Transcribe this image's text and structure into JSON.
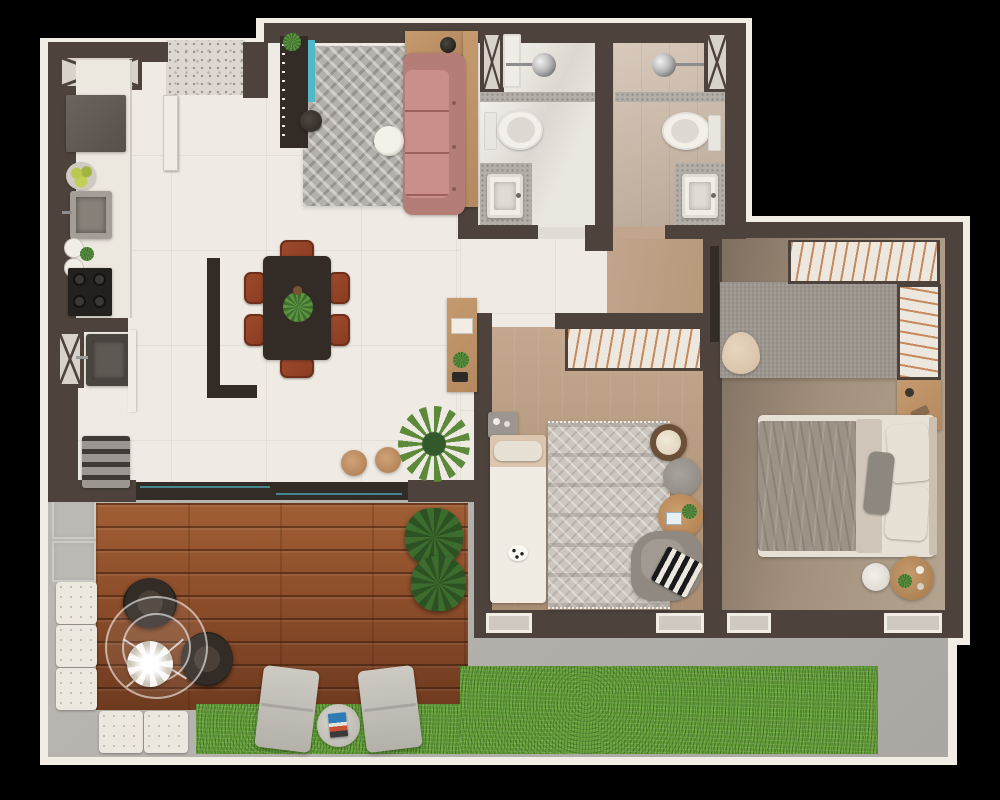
{
  "scene": {
    "kind": "apartment-floor-plan-3d-render",
    "view": "top-down",
    "background": "#000000",
    "visible_text": "none"
  },
  "palette": {
    "background": "#000000",
    "outline": "#f1ece4",
    "wall": "#4d433c",
    "wall_dark": "#332c26",
    "floor_living": "#efebe4",
    "terrazzo": "#dcd7d0",
    "corridor_wood": "#c2a58c",
    "bath1_floor": "#eae6e0",
    "bath2_floor": "#cfc0b1",
    "master_floor_a": "#b3a490",
    "master_floor_b": "#7e6e5e",
    "bed2_floor_a": "#c3a88e",
    "bed2_floor_b": "#a98d73",
    "concrete": "#b7b3ae",
    "concrete_tile": "#bdb9b4",
    "deck_a": "#8d4e2a",
    "deck_b": "#6e3a1f",
    "grass_a": "#67a23c",
    "sofa": "#c98f88",
    "sofa_dark": "#b47d76",
    "rug_living_a": "#b4b0ab",
    "rug_master": "#9e978f",
    "rug_boho_a": "#ccc6bf",
    "aquarium": "#4fb9c7",
    "wood": "#b5895f",
    "chair_rust": "#8a3c22",
    "chair_rust_dark": "#6e2e18",
    "plant": "#5d8a3a",
    "plant_dark": "#33592a",
    "linen": "#e7e0d4",
    "throw_gray": "#9c9286",
    "steel": "#8f8a84",
    "white_goods": "#ece7df",
    "hanger": "#c78a5e",
    "lounger": "#cdc9c3",
    "quilt": "#ece7df"
  },
  "rooms": [
    {
      "name": "kitchen",
      "furniture": [
        "refrigerator",
        "fruit-bowl",
        "kitchen-sink",
        "canisters",
        "cooktop-4-burners",
        "counter"
      ]
    },
    {
      "name": "laundry",
      "furniture": [
        "laundry-sink",
        "water-heater",
        "vent-shaft"
      ]
    },
    {
      "name": "living-dining",
      "furniture": [
        "tv-panel",
        "aquarium-strip",
        "herringbone-rug",
        "pink-sofa",
        "wood-console",
        "coffee-table",
        "dark-pouf",
        "dining-table",
        "dining-chairs-x6",
        "plant-centerpiece",
        "partition-divider",
        "wood-stools-x2",
        "palm-plant",
        "hall-console-desk",
        "entry-door"
      ]
    },
    {
      "name": "bathroom-1",
      "furniture": [
        "shower-head",
        "toilet",
        "vanity-sink",
        "mosaic-band",
        "vent-shaft"
      ]
    },
    {
      "name": "bathroom-2",
      "furniture": [
        "shower-head",
        "toilet",
        "vanity-sink",
        "mosaic-band",
        "vent-shaft"
      ]
    },
    {
      "name": "bedroom-2",
      "furniture": [
        "open-wardrobe",
        "single-bed",
        "nightstand",
        "boho-rug",
        "blanket-basket",
        "gray-pouf",
        "round-coffee-table",
        "armchair",
        "zigzag-pillow"
      ]
    },
    {
      "name": "master-bedroom",
      "furniture": [
        "l-shaped-wardrobe",
        "gray-rug",
        "beige-bench",
        "vanity-desk",
        "double-bed",
        "pillows",
        "side-table-white",
        "side-table-wood",
        "door-leaf"
      ]
    },
    {
      "name": "terrace",
      "furniture": [
        "wood-deck",
        "glass-dining-table",
        "flower-centerpiece",
        "wicker-chairs-x2",
        "large-planter",
        "sun-loungers-x2",
        "magazine-pouf",
        "quilted-ottoman-tiles-x5",
        "concrete-tiles",
        "lawn-grass"
      ]
    }
  ]
}
